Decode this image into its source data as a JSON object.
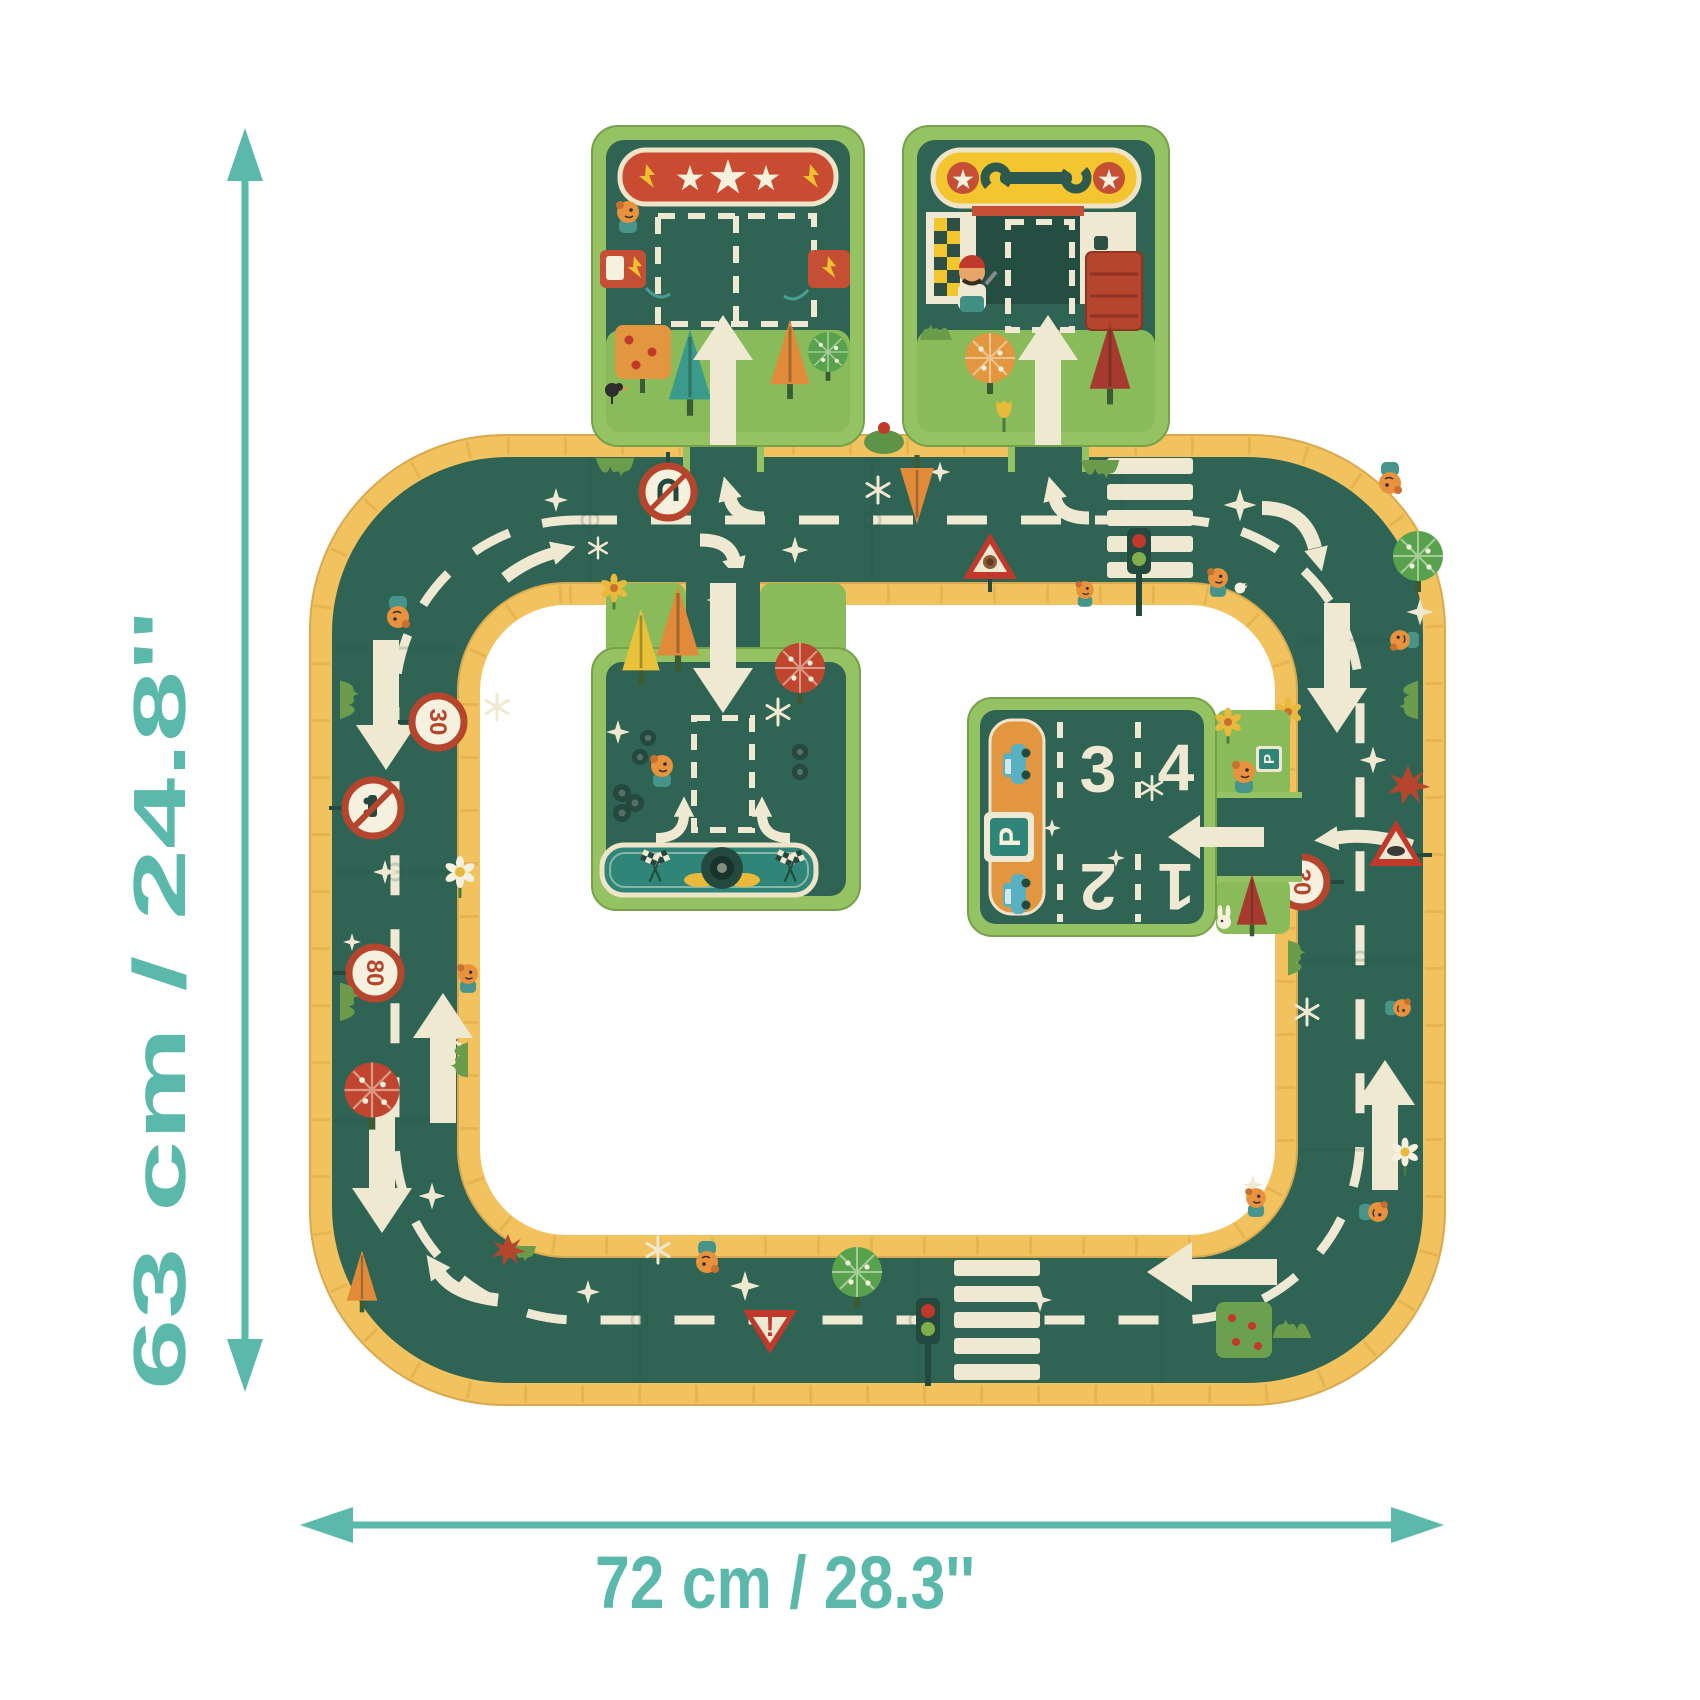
{
  "dimensions": {
    "height": "63 cm / 24.8''",
    "width": "72 cm / 28.3''"
  },
  "signs": {
    "speed_limit_left": "30",
    "speed_limit_lower_left": "80",
    "speed_limit_right": "30",
    "yield_mark": "!"
  },
  "parking": {
    "sign_letter": "P",
    "dog_sign_letter": "P",
    "spaces": [
      "1",
      "2",
      "3",
      "4"
    ]
  },
  "colors": {
    "accent_teal": "#5bb9ac",
    "brick_yellow": "#f2c25e",
    "road_green": "#2f6454",
    "marking_cream": "#f0e9d2",
    "tile_border_green": "#95c262",
    "grass_green": "#8abb5b",
    "banner_red": "#c94b32",
    "banner_yellow": "#f3c52e",
    "banner_teal": "#2f8577",
    "accent_orange": "#e2963f",
    "sign_red": "#b5452c"
  }
}
